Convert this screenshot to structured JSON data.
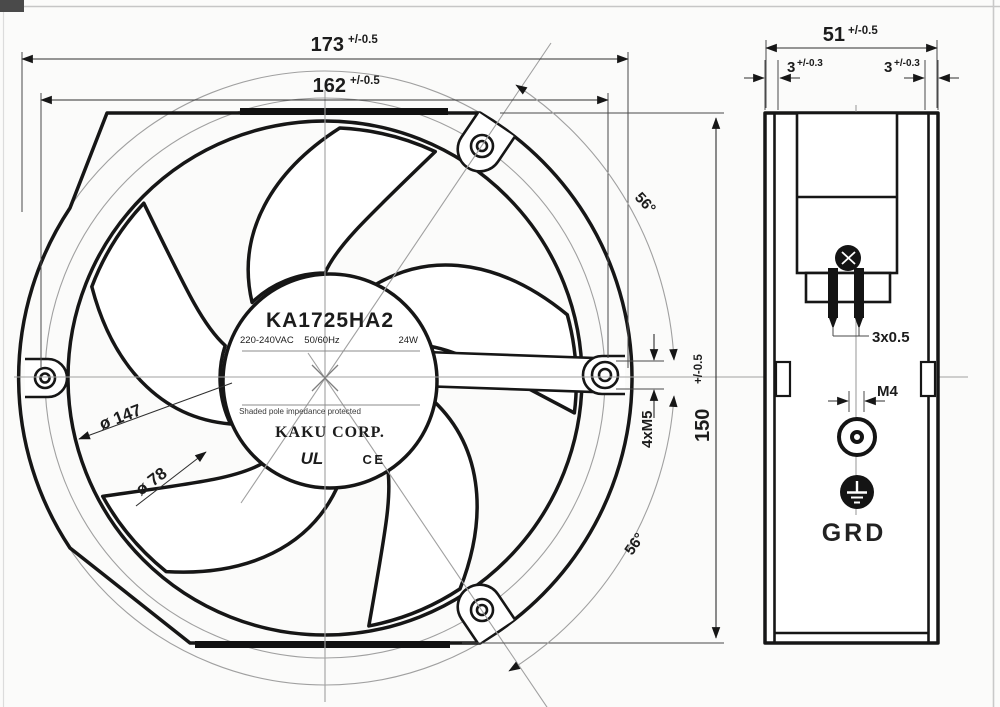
{
  "drawing": {
    "front": {
      "dim_width_outer": "173",
      "dim_width_outer_tol": "+/-0.5",
      "dim_width_inner": "162",
      "dim_width_inner_tol": "+/-0.5",
      "dim_height": "150",
      "dim_height_tol": "+/-0.5",
      "dim_dia_ring": "ø 147",
      "dim_dia_hub": "ø 78",
      "dim_holes": "4xM5",
      "angle_top": "56°",
      "angle_bottom": "56°",
      "hub": {
        "model": "KA1725HA2",
        "voltage": "220-240VAC",
        "frequency": "50/60Hz",
        "power": "24W",
        "protection": "Shaded pole impedance protected",
        "brand": "KAKU CORP.",
        "mark_ul": "UL",
        "mark_ce": "CE"
      }
    },
    "side": {
      "dim_depth": "51",
      "dim_depth_tol": "+/-0.5",
      "dim_flange_left": "3",
      "dim_flange_left_tol": "+/-0.3",
      "dim_flange_right": "3",
      "dim_flange_right_tol": "+/-0.3",
      "dim_lead_wire": "3x0.5",
      "dim_thread": "M4",
      "label_ground": "GRD"
    }
  }
}
